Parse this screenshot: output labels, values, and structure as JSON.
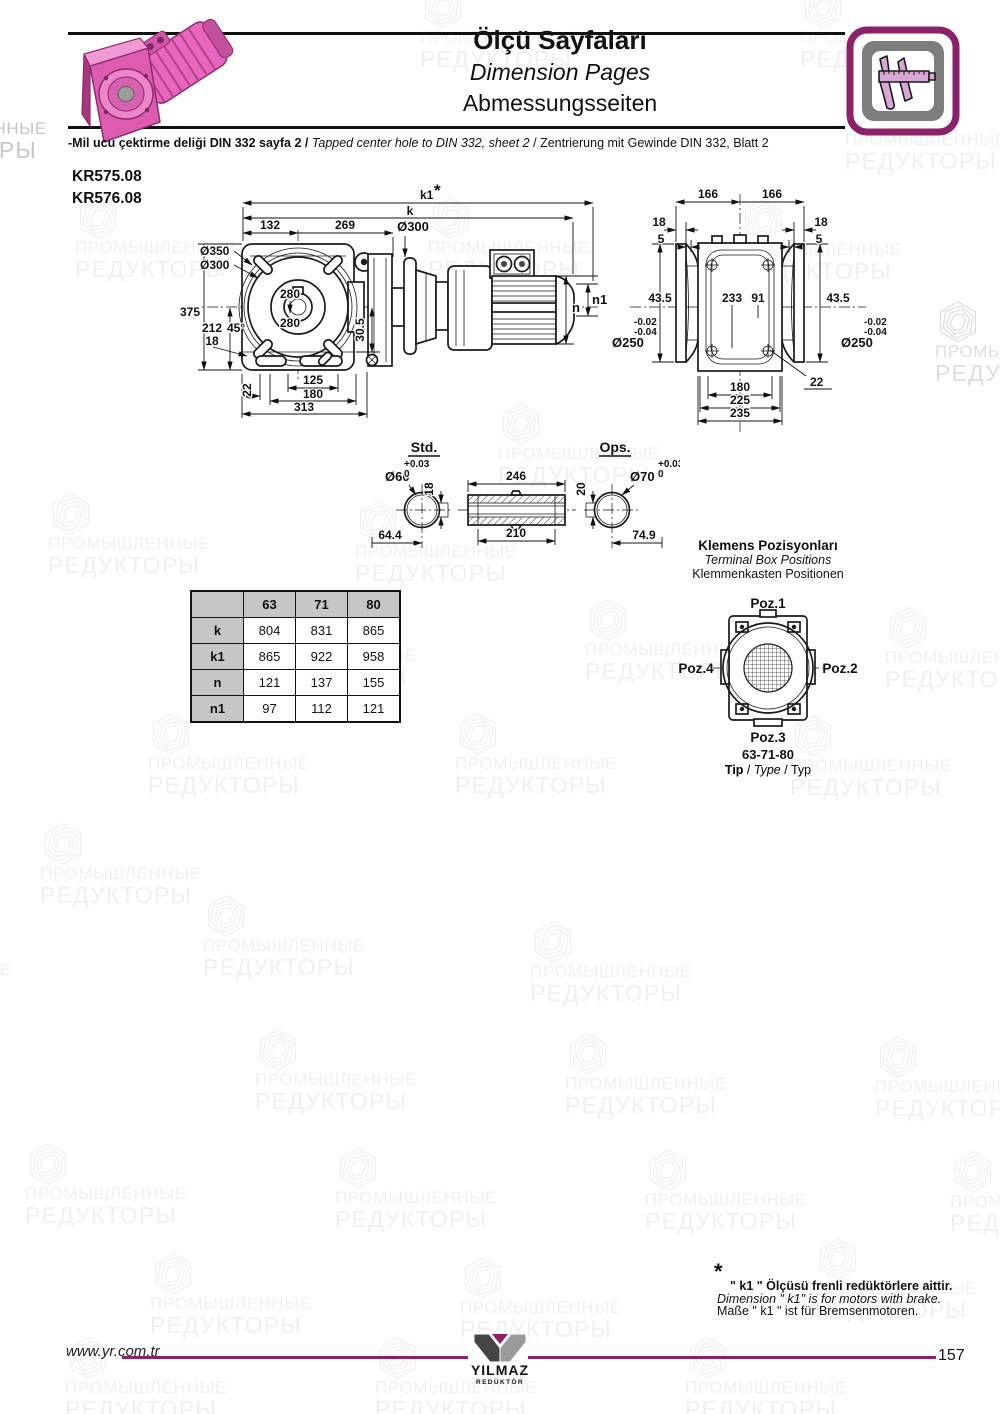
{
  "header": {
    "title_tr": "Ölçü Sayfaları",
    "title_en": "Dimension Pages",
    "title_de": "Abmessungsseiten"
  },
  "note": {
    "tr": "-Mil ucu çektirme deliği DIN 332 sayfa 2",
    "sep": "/",
    "en": "Tapped center hole to DIN 332, sheet 2",
    "de": "Zentrierung mit Gewinde DIN 332, Blatt 2"
  },
  "models": {
    "m1": "KR575.08",
    "m2": "KR576.08"
  },
  "watermark": {
    "line1": "ПРОМЫШЛЕННЫЕ",
    "line2": "РЕДУКТОРЫ"
  },
  "front_view": {
    "k1": "k1",
    "star": "*",
    "k": "k",
    "d132": "132",
    "d269": "269",
    "d300_top": "Ø300",
    "d350": "Ø350",
    "d300": "Ø300",
    "d280_top": "280",
    "d280_mid": "280",
    "d375": "375",
    "d212": "212",
    "d45": "45°",
    "d18": "18",
    "d22": "22",
    "d125": "125",
    "d180": "180",
    "d313": "313",
    "d30_5": "30.5",
    "n1": "n1",
    "n": "n"
  },
  "flange_view": {
    "d166_l": "166",
    "d166_r": "166",
    "d18_l": "18",
    "d5_l": "5",
    "d18_r": "18",
    "d5_r": "5",
    "d43_5_l": "43.5",
    "d233": "233",
    "d91": "91",
    "d43_5_r": "43.5",
    "tol_hi_l": "-0.02",
    "tol_lo_l": "-0.04",
    "d250_l": "Ø250",
    "tol_hi_r": "-0.02",
    "tol_lo_r": "-0.04",
    "d250_r": "Ø250",
    "d22": "22",
    "d180": "180",
    "d225": "225",
    "d235": "235"
  },
  "shaft_std": {
    "label": "Std.",
    "dia": "Ø60",
    "tol_hi": "+0.03",
    "tol_lo": "0",
    "key": "18",
    "len": "64.4"
  },
  "shaft_mid": {
    "d246": "246",
    "d210": "210"
  },
  "shaft_ops": {
    "label": "Ops.",
    "dia": "Ø70",
    "tol_hi": "+0.03",
    "tol_lo": "0",
    "key": "20",
    "len": "74.9"
  },
  "table": {
    "headers": [
      "63",
      "71",
      "80"
    ],
    "rows": [
      {
        "label": "k",
        "v": [
          "804",
          "831",
          "865"
        ]
      },
      {
        "label": "k1",
        "v": [
          "865",
          "922",
          "958"
        ]
      },
      {
        "label": "n",
        "v": [
          "121",
          "137",
          "155"
        ]
      },
      {
        "label": "n1",
        "v": [
          "97",
          "112",
          "121"
        ]
      }
    ]
  },
  "terminal": {
    "title_tr": "Klemens Pozisyonları",
    "title_en": "Terminal Box Positions",
    "title_de": "Klemmenkasten Positionen",
    "poz1": "Poz.1",
    "poz2": "Poz.2",
    "poz3": "Poz.3",
    "poz4": "Poz.4",
    "sizes": "63-71-80",
    "tip_tr": "Tip",
    "sep": " / ",
    "tip_en": "Type",
    "tip_de": "Typ"
  },
  "footnote": {
    "star": "*",
    "tr": "\" k1 \" Ölçüsü frenli redüktörlere aittir.",
    "en": "Dimension \" k1\" is for motors with brake.",
    "de": "Maße \" k1 \" ist für Bremsenmotoren."
  },
  "footer": {
    "site": "www.yr.com.tr",
    "logo": "YILMAZ",
    "logo_sub": "REDÜKTÖR",
    "page": "157"
  }
}
